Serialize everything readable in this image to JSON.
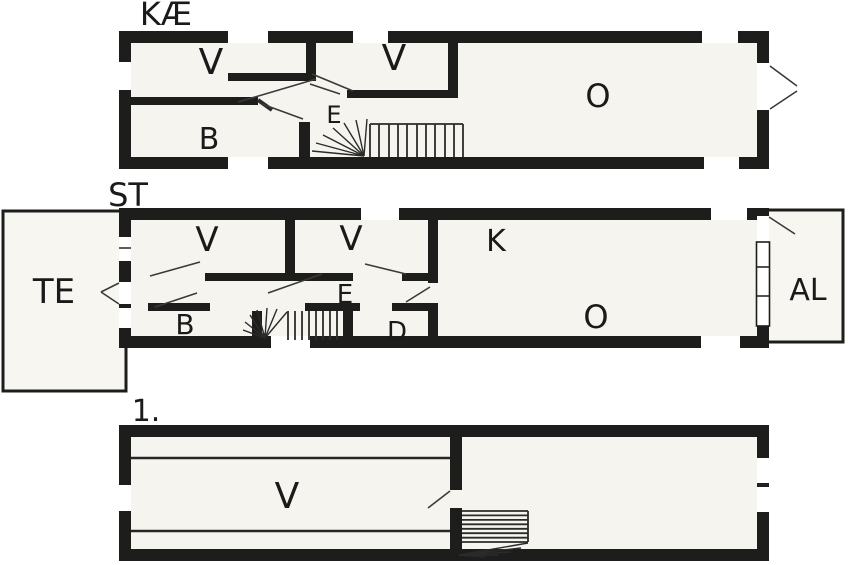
{
  "drawing": {
    "type": "floor-plan",
    "language": "da",
    "colors": {
      "wall": "#1d1d1b",
      "floor": "#f5f4ee",
      "background": "#ffffff"
    }
  },
  "floors": [
    {
      "id": "basement",
      "label": "KÆ",
      "rooms": [
        {
          "label": "V"
        },
        {
          "label": "V"
        },
        {
          "label": "E"
        },
        {
          "label": "B"
        },
        {
          "label": "O"
        }
      ]
    },
    {
      "id": "ground",
      "label": "ST",
      "rooms": [
        {
          "label": "TE"
        },
        {
          "label": "V"
        },
        {
          "label": "V"
        },
        {
          "label": "K"
        },
        {
          "label": "E"
        },
        {
          "label": "B"
        },
        {
          "label": "D"
        },
        {
          "label": "O"
        },
        {
          "label": "AL"
        }
      ]
    },
    {
      "id": "first",
      "label": "1.",
      "rooms": [
        {
          "label": "V"
        }
      ]
    }
  ]
}
